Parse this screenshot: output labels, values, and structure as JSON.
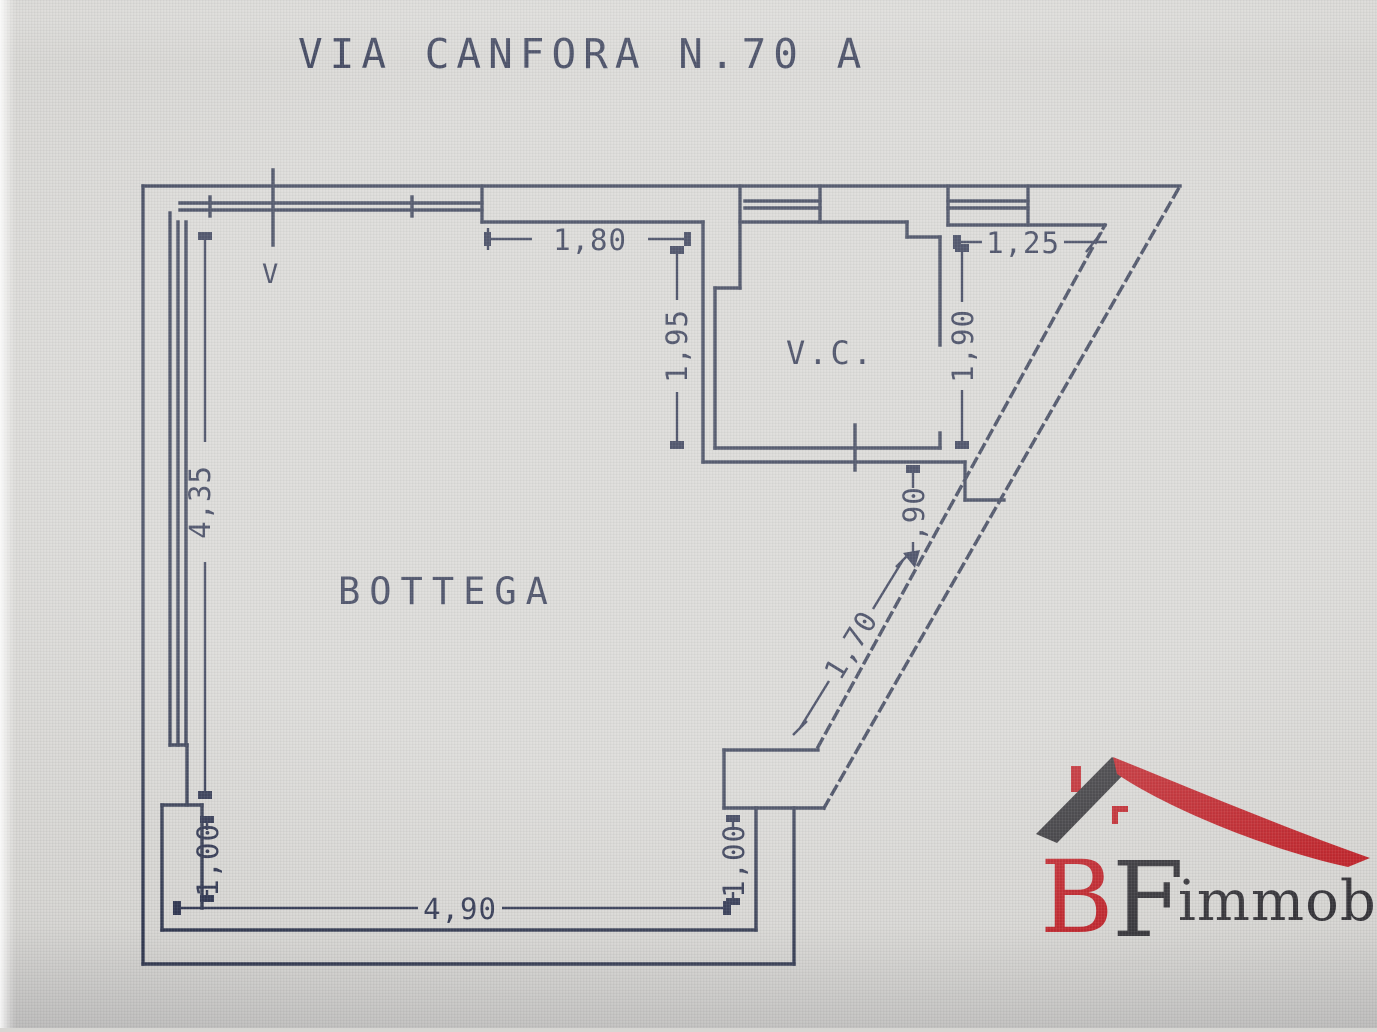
{
  "title": "VIA CANFORA N.70 A",
  "plan": {
    "rooms": {
      "main": "BOTTEGA",
      "wc": "V.C."
    },
    "window_marker": "V",
    "dimensions": {
      "top_opening": "1,80",
      "top_right": "1,25",
      "vc_left": "1,95",
      "vc_right": "1,90",
      "below_vc": ",90",
      "diagonal": "1,70",
      "left_wall": "4,35",
      "recess_left": "1,00",
      "recess_mid": "1,00",
      "bottom": "4,90"
    },
    "colors": {
      "line": "#333a52",
      "text": "#2e3550",
      "background": "#d7d6d3"
    }
  },
  "logo": {
    "initial_b": "B",
    "initial_f": "F",
    "wordmark": "immobiliare",
    "red": "#c0232a",
    "dark": "#36353a"
  }
}
